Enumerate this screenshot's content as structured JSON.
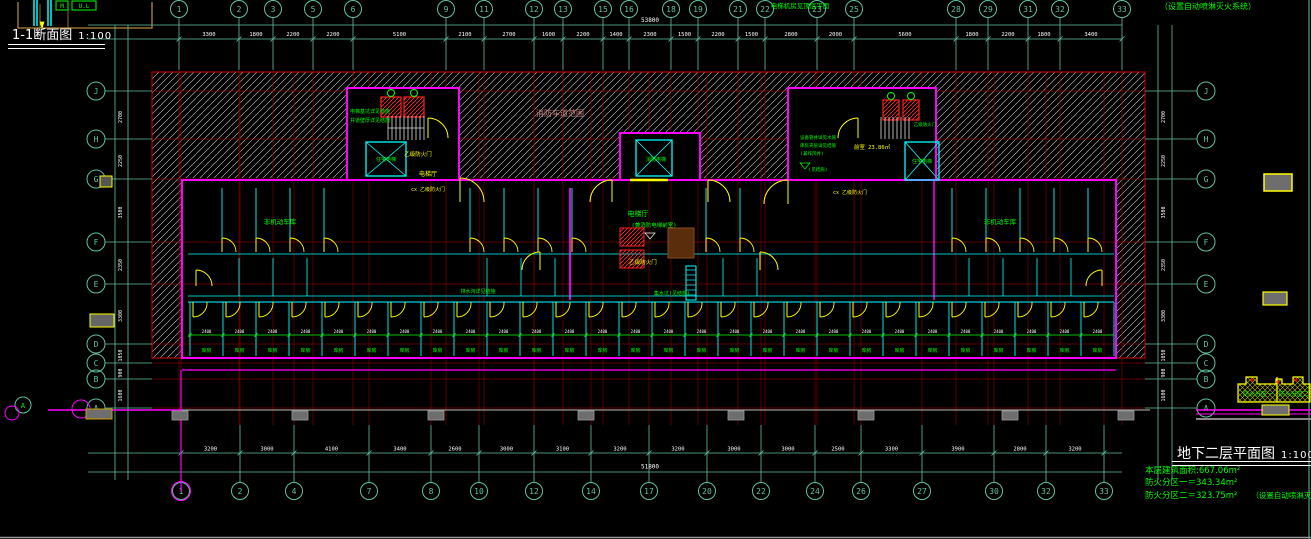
{
  "titles": {
    "section_title": "1-1断面图",
    "section_scale": "1:100",
    "plan_title": "地下二层平面图",
    "plan_scale": "1:100",
    "top_right_note": "（设置自动喷淋灭火系统）"
  },
  "notes": {
    "area_line": "本层建筑面积:667.06m²",
    "zone1_line": "防火分区一＝343.34m²",
    "zone2_line": "防火分区二＝323.75m²",
    "sprinkler_note": "（设置自动喷淋灭火系统）"
  },
  "key_plan": {
    "zone1": "防火分区一",
    "zone2": "防火分区二"
  },
  "grid": {
    "top_cols": [
      [
        "1",
        179
      ],
      [
        "2",
        239
      ],
      [
        "3",
        273
      ],
      [
        "5",
        313
      ],
      [
        "6",
        353
      ],
      [
        "9",
        446
      ],
      [
        "11",
        484
      ],
      [
        "12",
        534
      ],
      [
        "13",
        563
      ],
      [
        "15",
        603
      ],
      [
        "16",
        629
      ],
      [
        "18",
        671
      ],
      [
        "19",
        698
      ],
      [
        "21",
        738
      ],
      [
        "22",
        765
      ],
      [
        "23",
        817
      ],
      [
        "25",
        854
      ],
      [
        "28",
        956
      ],
      [
        "29",
        988
      ],
      [
        "31",
        1028
      ],
      [
        "32",
        1060
      ],
      [
        "33",
        1122
      ]
    ],
    "bottom_cols": [
      [
        "1",
        181
      ],
      [
        "2",
        240
      ],
      [
        "4",
        294
      ],
      [
        "7",
        369
      ],
      [
        "8",
        431
      ],
      [
        "10",
        479
      ],
      [
        "12",
        534
      ],
      [
        "14",
        591
      ],
      [
        "17",
        649
      ],
      [
        "20",
        707
      ],
      [
        "22",
        761
      ],
      [
        "24",
        815
      ],
      [
        "26",
        861
      ],
      [
        "27",
        922
      ],
      [
        "30",
        994
      ],
      [
        "32",
        1046
      ],
      [
        "33",
        1104
      ]
    ],
    "rows": [
      [
        "J",
        91
      ],
      [
        "H",
        139
      ],
      [
        "G",
        179
      ],
      [
        "F",
        242
      ],
      [
        "E",
        284
      ],
      [
        "D",
        344
      ],
      [
        "C",
        363
      ],
      [
        "B",
        379
      ],
      [
        "A",
        408
      ]
    ]
  },
  "dims": {
    "top": [
      "3300",
      "1800",
      "2200",
      "2200",
      "5100",
      "2100",
      "2700",
      "1600",
      "2200",
      "1400",
      "2300",
      "1500",
      "2200",
      "1500",
      "2800",
      "2000",
      "5600",
      "1800",
      "2200",
      "1800",
      "3400"
    ],
    "bottom": [
      "3200",
      "3000",
      "4100",
      "3400",
      "2600",
      "3000",
      "3100",
      "3200",
      "3200",
      "3000",
      "3000",
      "2500",
      "3300",
      "3900",
      "2800",
      "3200"
    ],
    "left": [
      "2700",
      "2250",
      "3500",
      "2350",
      "3300",
      "1050",
      "900",
      "1600"
    ],
    "right": [
      "2700",
      "2250",
      "3500",
      "2350",
      "3300",
      "1050",
      "900",
      "1600"
    ],
    "top_total": "53800",
    "bottom_total": "51800"
  },
  "storage": {
    "room_label": "库房",
    "cell_dim": "2400"
  },
  "section_fragment": {
    "tag1": "M",
    "tag2": "U.L"
  },
  "plan_labels": [
    {
      "t": "消防车道范围",
      "x": 560,
      "y": 116,
      "c": "salmon",
      "s": 8
    },
    {
      "t": "电梯机房见顶层平面",
      "x": 800,
      "y": 8,
      "c": "green",
      "s": 6.5
    },
    {
      "t": "消防电梯",
      "x": 656,
      "y": 161,
      "c": "green",
      "s": 5
    },
    {
      "t": "电梯厅",
      "x": 638,
      "y": 216,
      "c": "green",
      "s": 7
    },
    {
      "t": "(兼消防电梯前室)",
      "x": 654,
      "y": 227,
      "c": "green",
      "s": 5.5
    },
    {
      "t": "乙级防火门",
      "x": 643,
      "y": 264,
      "c": "yellow",
      "s": 5.5
    },
    {
      "t": "住宅电梯",
      "x": 386,
      "y": 161,
      "c": "green",
      "s": 5
    },
    {
      "t": "乙级防火门",
      "x": 418,
      "y": 156,
      "c": "yellow",
      "s": 5.5
    },
    {
      "t": "电梯厅",
      "x": 428,
      "y": 176,
      "c": "yellow",
      "s": 6
    },
    {
      "t": "cx 乙级防火门",
      "x": 428,
      "y": 191,
      "c": "yellow",
      "s": 5
    },
    {
      "t": "电梯基坑详见结施",
      "x": 370,
      "y": 113,
      "c": "green",
      "s": 5
    },
    {
      "t": "井道壁厚详见结施",
      "x": 370,
      "y": 122,
      "c": "green",
      "s": 5
    },
    {
      "t": "住宅电梯",
      "x": 922,
      "y": 163,
      "c": "green",
      "s": 5
    },
    {
      "t": "乙级防火门",
      "x": 925,
      "y": 126,
      "c": "green",
      "s": 4.5
    },
    {
      "t": "前室 23.86㎡",
      "x": 872,
      "y": 149,
      "c": "yellow",
      "s": 5.5
    },
    {
      "t": "cx 乙级防火门",
      "x": 850,
      "y": 194,
      "c": "yellow",
      "s": 5
    },
    {
      "t": "设备管井详见水施",
      "x": 818,
      "y": 139,
      "c": "green",
      "s": 4.5
    },
    {
      "t": "库房夹层详见结施",
      "x": 818,
      "y": 147,
      "c": "green",
      "s": 4.5
    },
    {
      "t": "(兼作风井)",
      "x": 812,
      "y": 155,
      "c": "green",
      "s": 4.5
    },
    {
      "t": "(见结施)",
      "x": 818,
      "y": 171,
      "c": "green",
      "s": 4.5
    },
    {
      "t": "非机动车库",
      "x": 280,
      "y": 224,
      "c": "green",
      "s": 6.5
    },
    {
      "t": "非机动车库",
      "x": 1000,
      "y": 224,
      "c": "green",
      "s": 6.5
    },
    {
      "t": "集水坑(见结施)",
      "x": 672,
      "y": 295,
      "c": "green",
      "s": 5
    },
    {
      "t": "排水沟详见结施",
      "x": 478,
      "y": 293,
      "c": "green",
      "s": 5
    }
  ],
  "colors": {
    "teal": "#5fc39c",
    "red_axis": "#7c0000",
    "red_bright": "#d00000",
    "magenta": "#ff00ff",
    "cyan": "#00ffff",
    "yellow": "#ffff00",
    "green": "#00ff00",
    "white": "#ffffff",
    "salmon": "#cd8080",
    "gray": "#6e6e6e",
    "hatch": "#a9a9a9",
    "brown": "#b08838"
  }
}
